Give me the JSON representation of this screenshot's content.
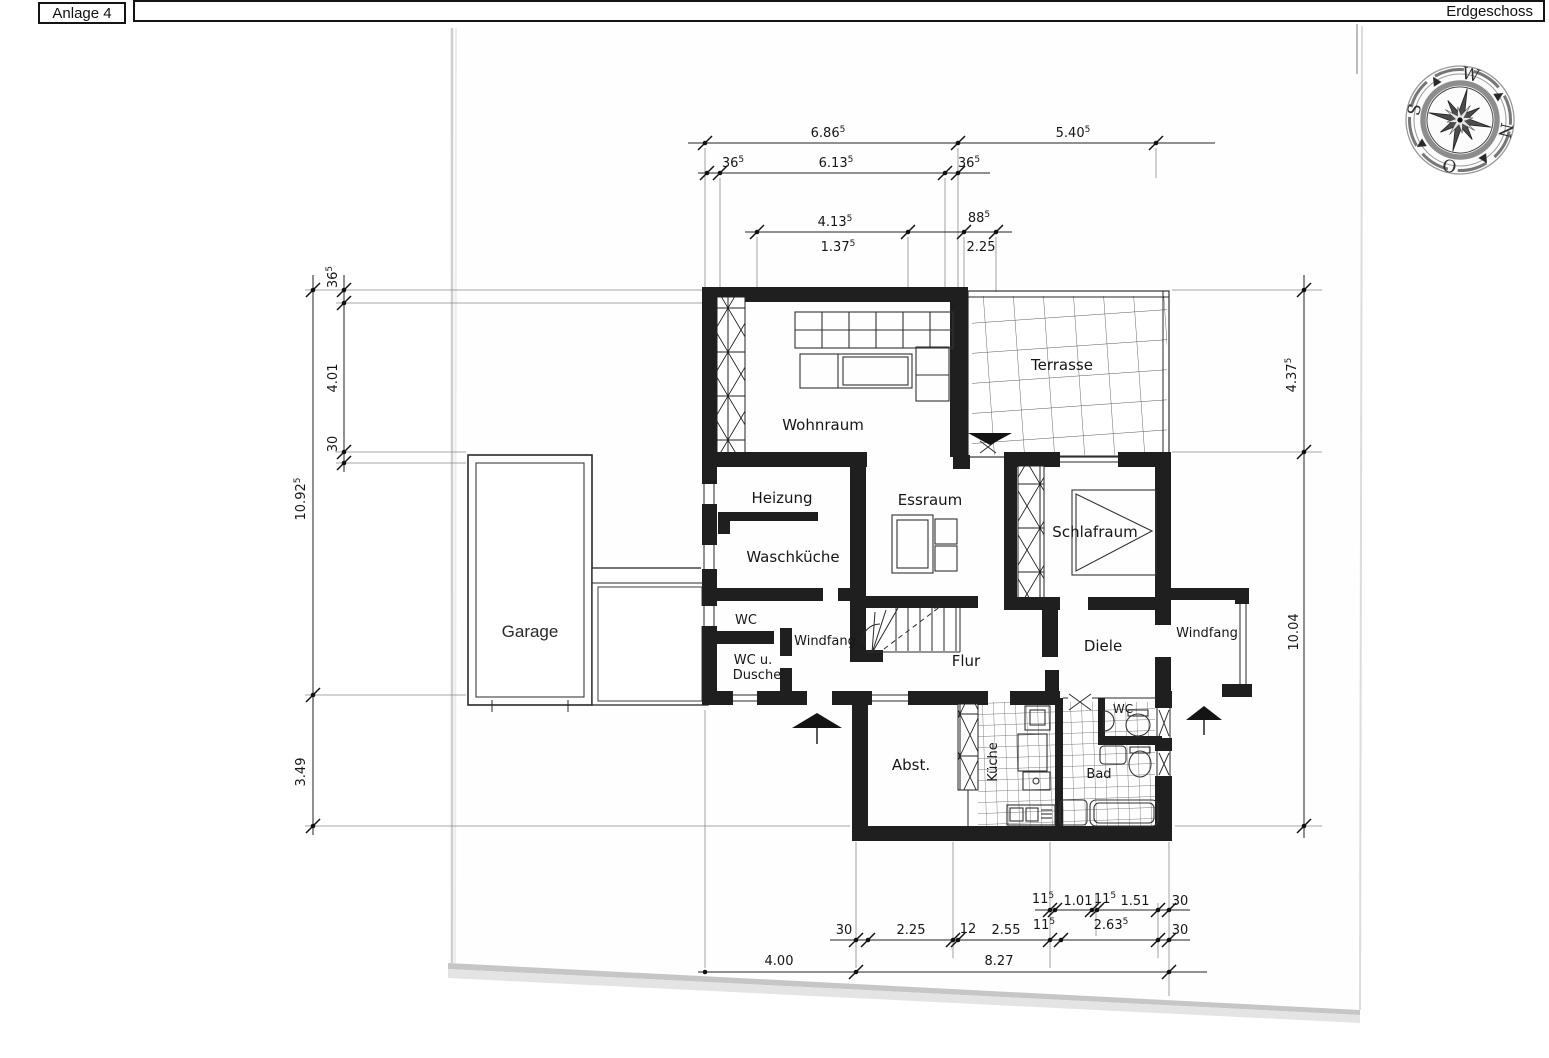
{
  "header": {
    "left_label": "Anlage 4",
    "right_label": "Erdgeschoss"
  },
  "compass": {
    "top": "W",
    "right": "N",
    "bottom": "O",
    "left": "S"
  },
  "rooms": {
    "wohnraum": "Wohnraum",
    "terrasse": "Terrasse",
    "heizung": "Heizung",
    "waschkueche": "Waschküche",
    "wc": "WC",
    "windfang_left": "Windfang",
    "wc_dusche_line1": "WC u.",
    "wc_dusche_line2": "Dusche",
    "essraum": "Essraum",
    "schlafraum": "Schlafraum",
    "flur": "Flur",
    "diele": "Diele",
    "windfang_right": "Windfang",
    "garage": "Garage",
    "abstellraum": "Abst.",
    "kueche": "Küche",
    "bad": "Bad",
    "wc_bad": "WC"
  },
  "dims": {
    "top1": [
      {
        "v": "6.86",
        "s": "5"
      },
      {
        "v": "5.40",
        "s": "5"
      }
    ],
    "top2": [
      {
        "v": "36",
        "s": "5"
      },
      {
        "v": "6.13",
        "s": "5"
      },
      {
        "v": "36",
        "s": "5"
      }
    ],
    "top3": [
      {
        "v": "4.13",
        "s": "5"
      },
      {
        "v": "1.37",
        "s": "5"
      },
      {
        "v": "88",
        "s": "5"
      },
      {
        "v": "2.25",
        "s": ""
      }
    ],
    "left": [
      {
        "v": "36",
        "s": "5"
      },
      {
        "v": "4.01",
        "s": ""
      },
      {
        "v": "30",
        "s": ""
      },
      {
        "v": "10.92",
        "s": "5"
      },
      {
        "v": "3.49",
        "s": ""
      }
    ],
    "right": [
      {
        "v": "4.37",
        "s": "5"
      },
      {
        "v": "10.04",
        "s": ""
      }
    ],
    "bottomA": [
      {
        "v": "11",
        "s": "5"
      },
      {
        "v": "1.01",
        "s": ""
      },
      {
        "v": "11",
        "s": "5"
      },
      {
        "v": "1.51",
        "s": ""
      },
      {
        "v": "30",
        "s": ""
      }
    ],
    "bottomB": [
      {
        "v": "30",
        "s": ""
      },
      {
        "v": "2.25",
        "s": ""
      },
      {
        "v": "12",
        "s": ""
      },
      {
        "v": "2.55",
        "s": ""
      },
      {
        "v": "11",
        "s": "5"
      },
      {
        "v": "2.63",
        "s": "5"
      },
      {
        "v": "30",
        "s": ""
      }
    ],
    "bottomC": [
      {
        "v": "4.00",
        "s": ""
      },
      {
        "v": "8.27",
        "s": ""
      }
    ]
  },
  "colors": {
    "ink": "#1a1a1a",
    "wall": "#1f1f1f",
    "paper": "#ffffff",
    "shadow": "#c6c6c6"
  }
}
